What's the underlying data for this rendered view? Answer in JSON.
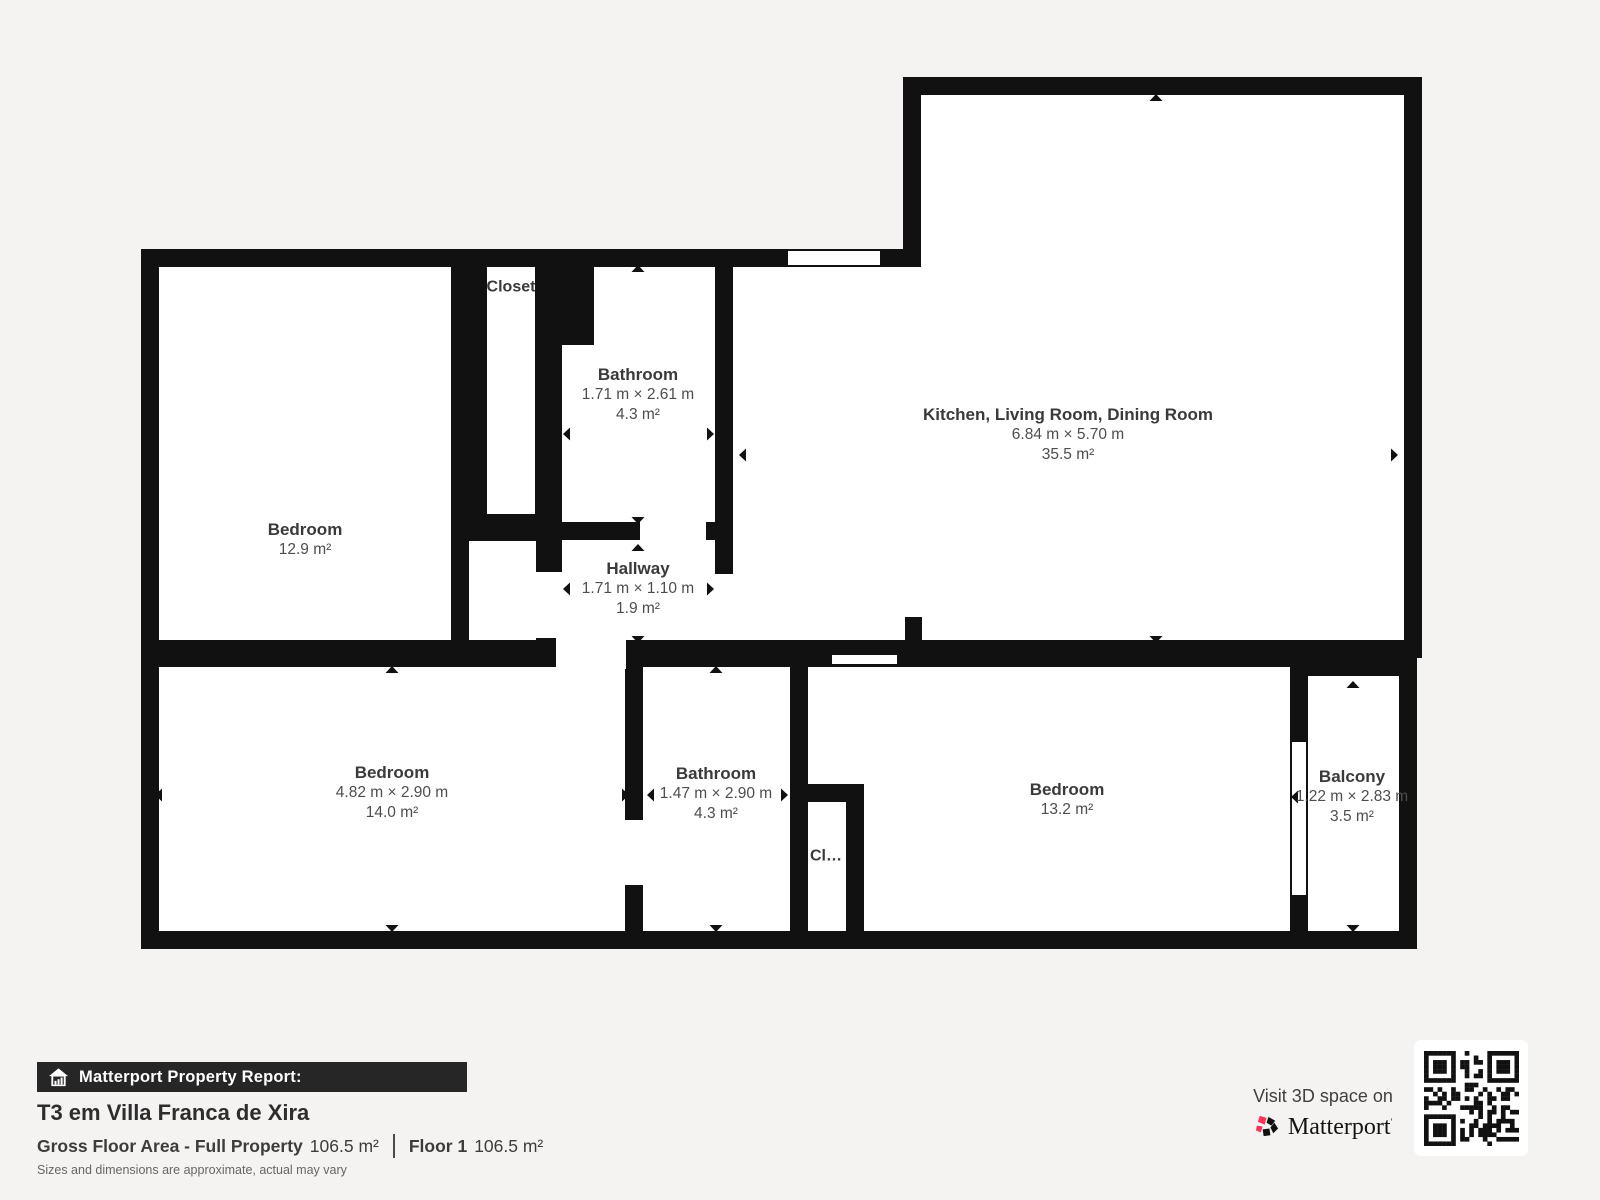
{
  "plan": {
    "rooms": [
      {
        "name": "Bedroom",
        "area": "12.9 m²"
      },
      {
        "name": "Closet"
      },
      {
        "name": "Bathroom",
        "dims": "1.71 m × 2.61 m",
        "area": "4.3 m²"
      },
      {
        "name": "Hallway",
        "dims": "1.71 m × 1.10 m",
        "area": "1.9 m²"
      },
      {
        "name": "Kitchen, Living Room, Dining Room",
        "dims": "6.84 m × 5.70 m",
        "area": "35.5 m²"
      },
      {
        "name": "Bedroom",
        "dims": "4.82 m × 2.90 m",
        "area": "14.0 m²"
      },
      {
        "name": "Bathroom",
        "dims": "1.47 m × 2.90 m",
        "area": "4.3 m²"
      },
      {
        "name": "Cl…"
      },
      {
        "name": "Bedroom",
        "area": "13.2 m²"
      },
      {
        "name": "Balcony",
        "dims": "1.22 m × 2.83 m",
        "area": "3.5 m²"
      }
    ]
  },
  "footer": {
    "report_label": "Matterport Property Report:",
    "property_title": "T3 em Villa Franca de Xira",
    "gross_label": "Gross Floor Area - Full Property",
    "gross_value": "106.5 m²",
    "floor_label": "Floor 1",
    "floor_value": "106.5 m²",
    "disclaimer": "Sizes and dimensions are approximate, actual may vary",
    "visit_text": "Visit 3D space on",
    "brand": "Matterport"
  },
  "colors": {
    "background": "#f5f3f1",
    "wall": "#111111",
    "room_fill": "#ffffff",
    "label_text": "#3d3d3d",
    "bar_background": "#262626",
    "brand_pink": "#ff3158"
  }
}
